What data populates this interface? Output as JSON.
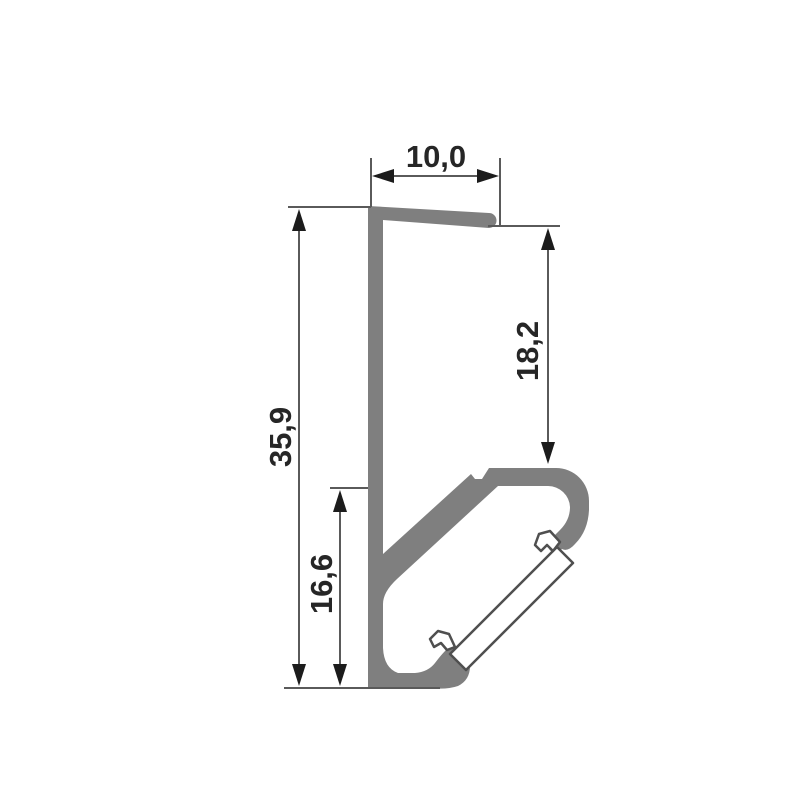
{
  "figure": {
    "type": "technical-drawing",
    "subject": "aluminium LED profile cross-section with diffuser cover",
    "decimal_style": "comma",
    "colors": {
      "background": "#ffffff",
      "profile_fill": "#7f7f7f",
      "cover_fill": "#ffffff",
      "cover_stroke": "#4f4f4f",
      "dimension_line": "#4a4a4a",
      "extension_line": "#5a5a5a",
      "arrow_fill": "#1c1c1c",
      "text": "#262626"
    },
    "dimensions": {
      "top_width": "10,0",
      "right_height": "18,2",
      "left_height": "35,9",
      "inner_height": "16,6"
    }
  }
}
